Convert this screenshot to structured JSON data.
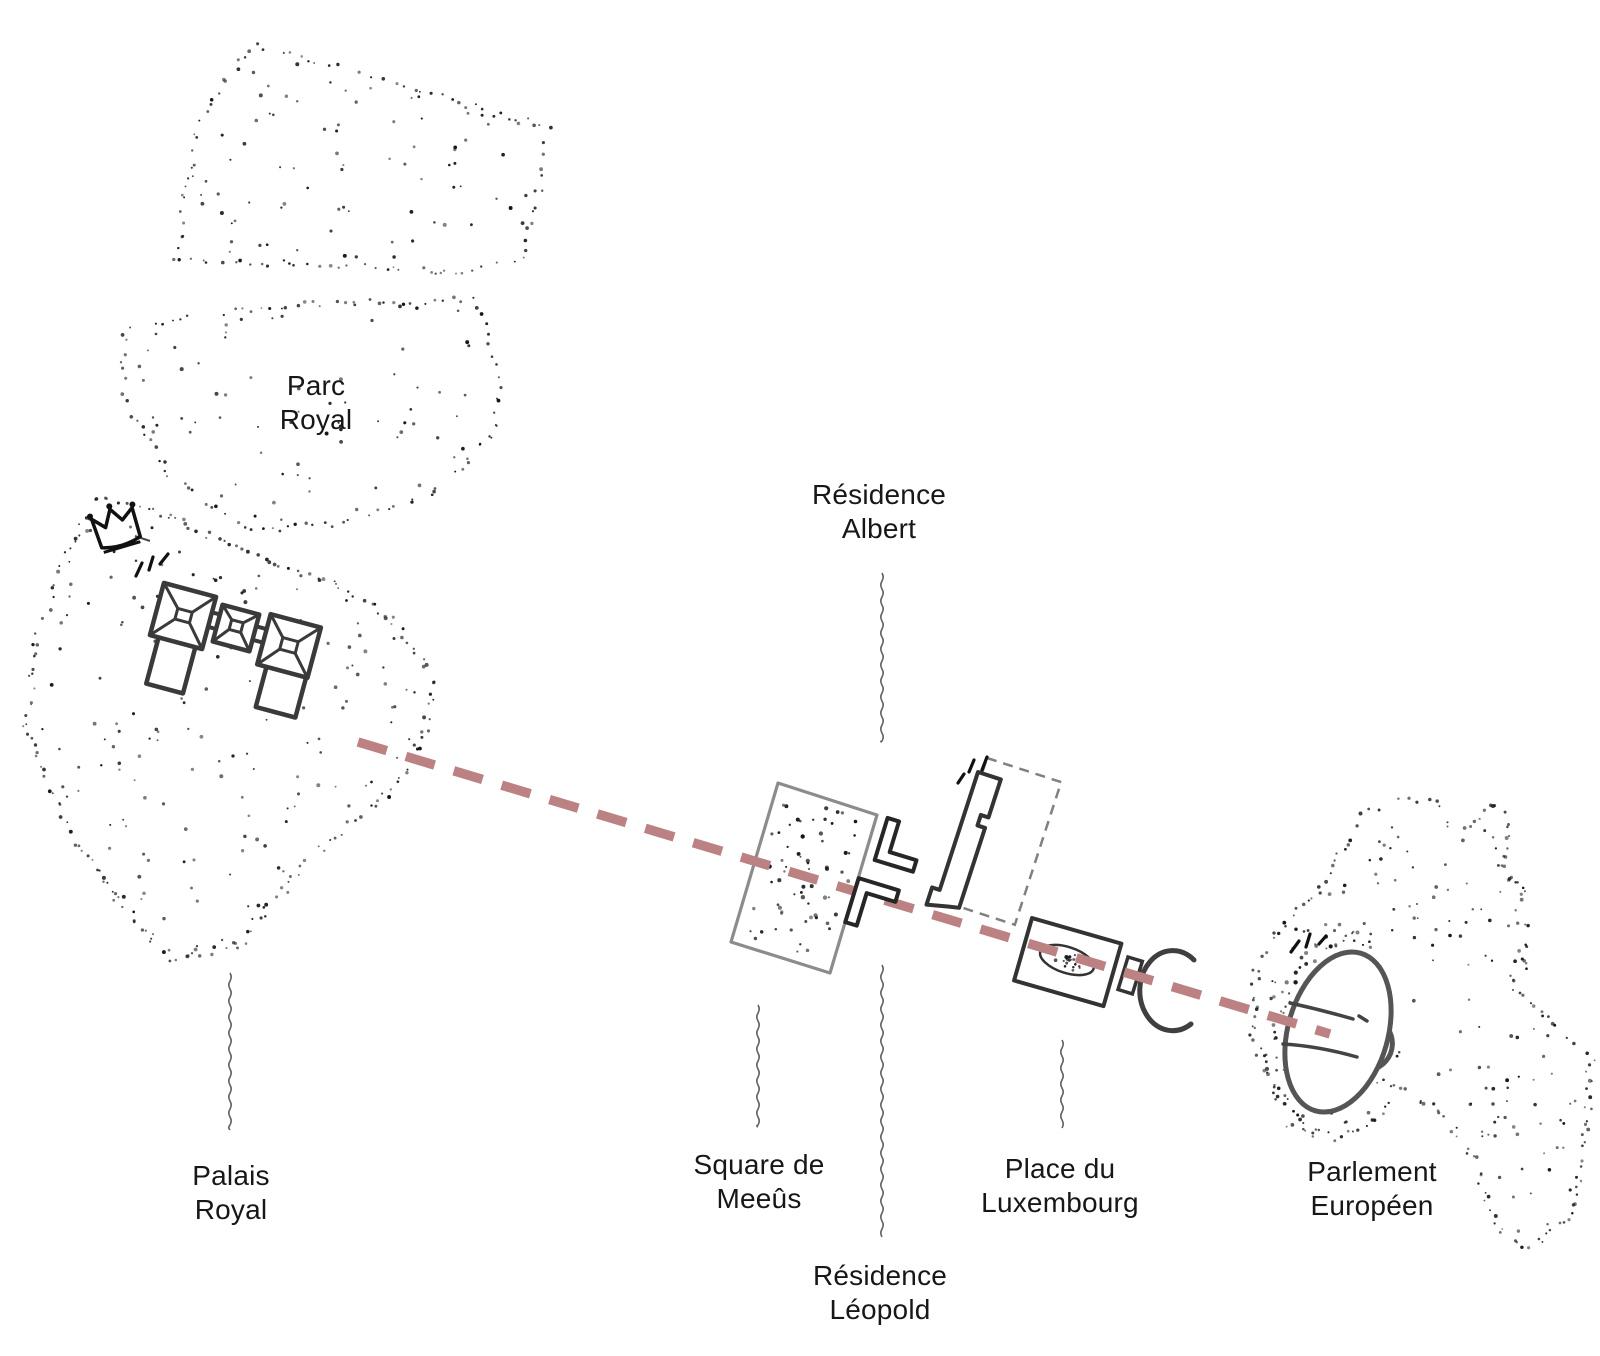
{
  "page": {
    "title": "Hand-drawn location map of the Brussels royal axis",
    "background": "#ffffff"
  },
  "colors": {
    "ink": "#161616",
    "palace_stroke": "#3a3a3a",
    "square_outline": "#8c8c8c",
    "building_stroke": "#262626",
    "hemicycle_stroke": "#555555",
    "leader_line": "#5f5f5f",
    "axis_dash": "#bc8283",
    "label_text": "#171717"
  },
  "labels": {
    "parc_royal": {
      "lines": [
        "Parc",
        "Royal"
      ],
      "x": 316,
      "y": 403
    },
    "residence_albert": {
      "lines": [
        "Résidence",
        "Albert"
      ],
      "x": 879,
      "y": 512
    },
    "palais_royal": {
      "lines": [
        "Palais",
        "Royal"
      ],
      "x": 231,
      "y": 1193
    },
    "square_de_meeus": {
      "lines": [
        "Square de",
        "Meeûs"
      ],
      "x": 759,
      "y": 1182
    },
    "place_du_luxembourg": {
      "lines": [
        "Place du",
        "Luxembourg"
      ],
      "x": 1060,
      "y": 1186
    },
    "parlement_europeen": {
      "lines": [
        "Parlement",
        "Européen"
      ],
      "x": 1372,
      "y": 1189
    },
    "residence_leopold": {
      "lines": [
        "Résidence",
        "Léopold"
      ],
      "x": 880,
      "y": 1293
    }
  },
  "axis_line": {
    "x1": 358,
    "y1": 742,
    "x2": 1330,
    "y2": 1034,
    "color": "#bc8283",
    "width": 9.5,
    "dash": "30 20"
  },
  "features": [
    {
      "name": "Parc Royal",
      "kind": "stippled park area"
    },
    {
      "name": "Palais Royal",
      "kind": "palace plan with crown icon"
    },
    {
      "name": "Square de Meeûs",
      "kind": "stippled square"
    },
    {
      "name": "Place du Luxembourg",
      "kind": "square with oval"
    },
    {
      "name": "Parlement Européen",
      "kind": "hemicycle plan"
    },
    {
      "name": "sight axis",
      "kind": "red dashed line from Palais Royal to Parlement Européen"
    }
  ]
}
